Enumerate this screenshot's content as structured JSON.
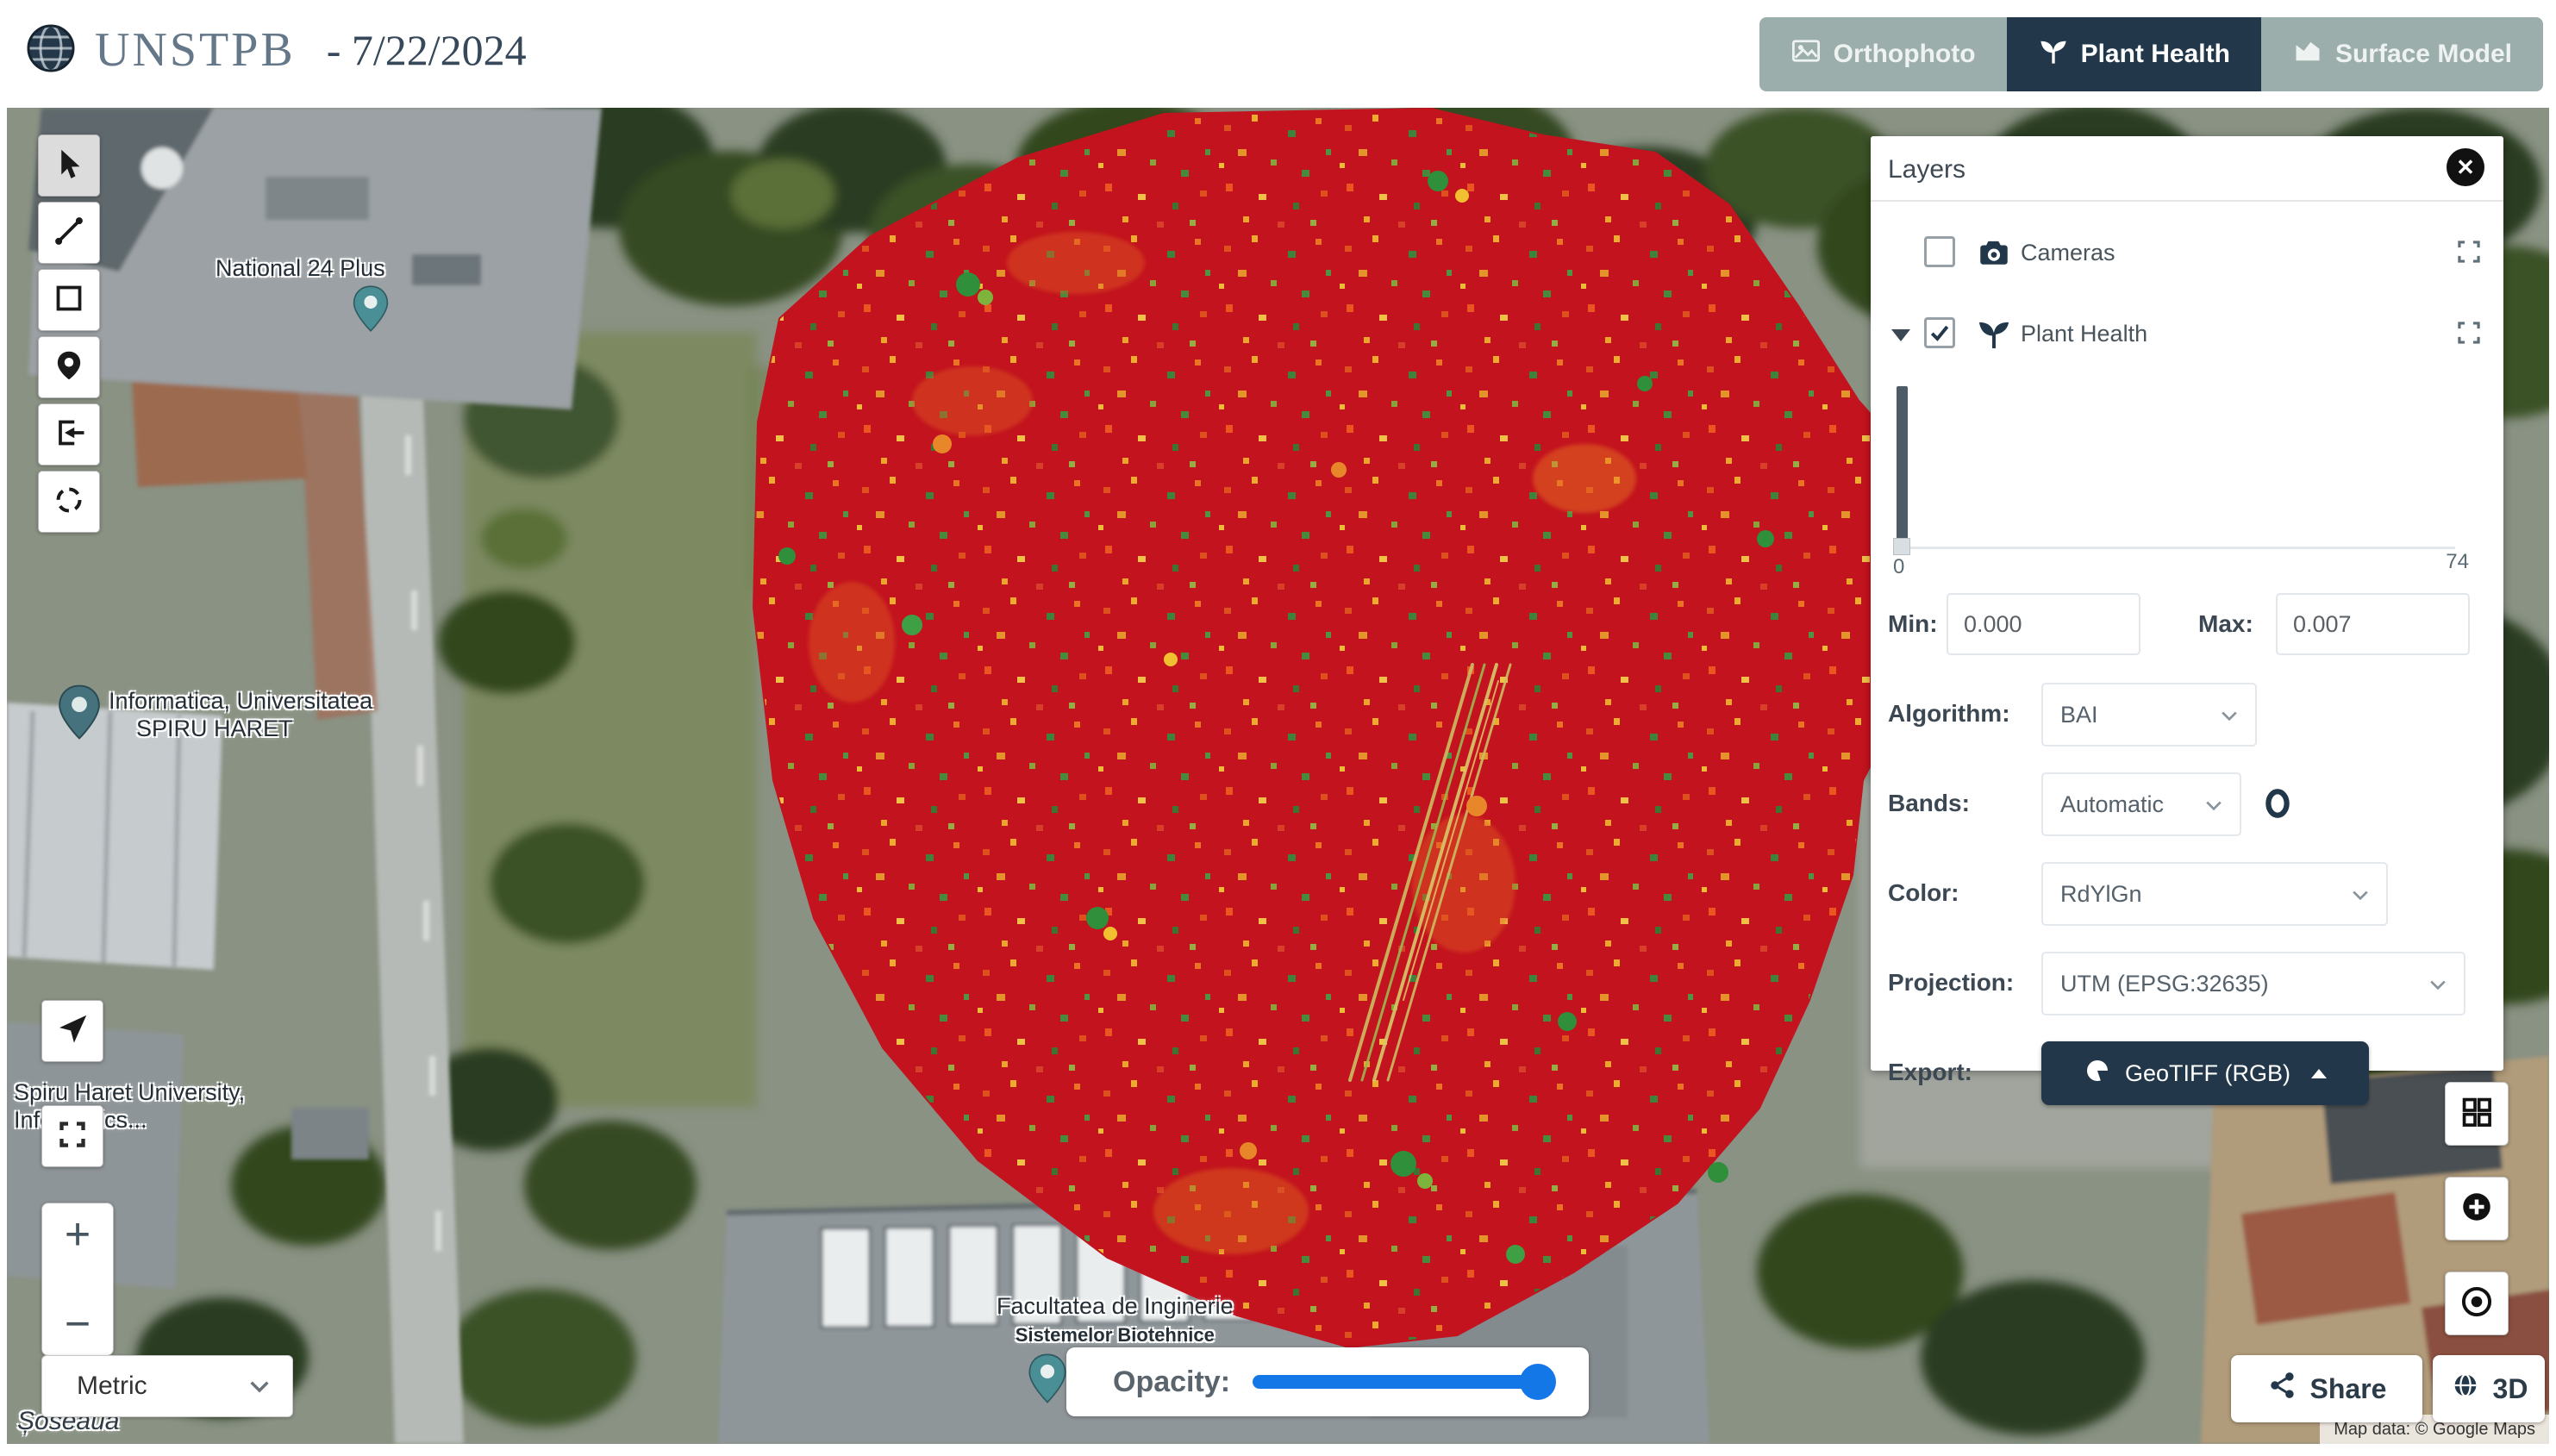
{
  "header": {
    "project_title": "UNSTPB",
    "date_label": "- 7/22/2024",
    "tabs": [
      {
        "label": "Orthophoto"
      },
      {
        "label": "Plant Health"
      },
      {
        "label": "Surface Model"
      }
    ]
  },
  "layers_panel": {
    "title": "Layers",
    "close_glyph": "✕",
    "layers": [
      {
        "label": "Cameras",
        "checked": false
      },
      {
        "label": "Plant Health",
        "checked": true
      }
    ],
    "histogram": {
      "range_min": "0",
      "range_max": "74"
    },
    "min_label": "Min:",
    "min_value": "0.000",
    "max_label": "Max:",
    "max_value": "0.007",
    "algorithm_label": "Algorithm:",
    "algorithm_value": "BAI",
    "bands_label": "Bands:",
    "bands_value": "Automatic",
    "color_label": "Color:",
    "color_value": "RdYlGn",
    "projection_label": "Projection:",
    "projection_value": "UTM (EPSG:32635)",
    "export_label": "Export:",
    "export_button_label": "GeoTIFF (RGB)"
  },
  "map": {
    "place_labels": {
      "national": "National 24 Plus",
      "informatica_line1": "Informatica, Universitatea",
      "informatica_line2": "SPIRU HARET",
      "spiru_line1": "Spiru Haret University,",
      "spiru_line2": "Informatics...",
      "facultatea_line1": "Facultatea de Inginerie",
      "facultatea_line2": "Sistemelor Biotehnice",
      "street": "Șoseaua"
    },
    "attribution": "Map data: © Google Maps"
  },
  "controls": {
    "units_value": "Metric",
    "opacity_label": "Opacity:",
    "opacity_percent": 100,
    "zoom_in": "+",
    "zoom_out": "−",
    "share_label": "Share",
    "threed_label": "3D"
  },
  "colors": {
    "accent_navy": "#22384a",
    "slider_blue": "#1377e8",
    "overlay_red": "#c2131e",
    "tab_inactive": "#94a7a4"
  }
}
